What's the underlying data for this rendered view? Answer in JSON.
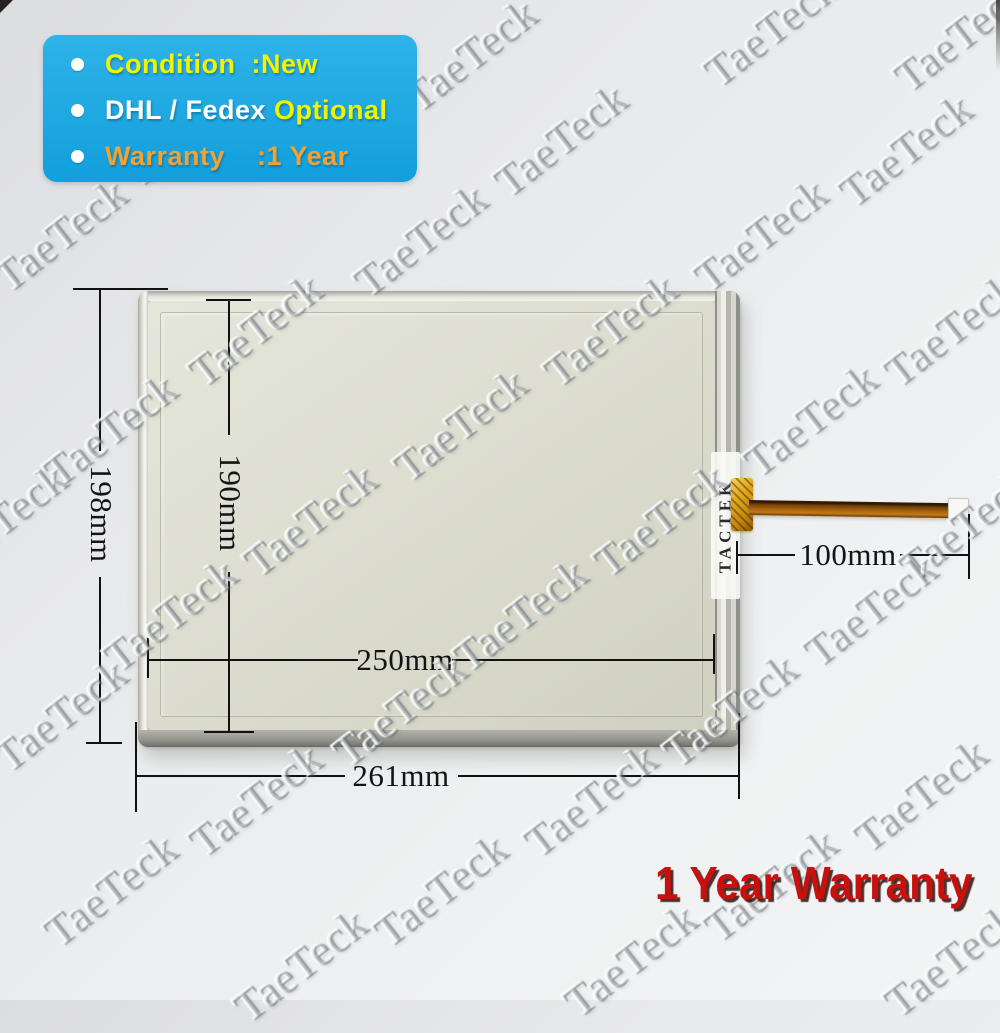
{
  "badge": {
    "bg_color_top": "#2fb3e8",
    "bg_color_bottom": "#129fdc",
    "items": [
      {
        "segments": [
          {
            "text": "Condition  :New",
            "color": "#f0f400"
          }
        ]
      },
      {
        "segments": [
          {
            "text": "DHL / Fedex ",
            "color": "#ffffff"
          },
          {
            "text": "Optional",
            "color": "#f0f400"
          }
        ]
      },
      {
        "segments": [
          {
            "text": "Warranty    :1 Year",
            "color": "#f0a235"
          }
        ]
      }
    ]
  },
  "panel": {
    "brand_label": "TACTEK"
  },
  "measurements": {
    "outer_height": "198mm",
    "inner_height": "190mm",
    "inner_width": "250mm",
    "outer_width": "261mm",
    "cable_length": "100mm"
  },
  "footer": {
    "warranty_text": "1 Year Warranty",
    "color": "#c8100d"
  },
  "watermark": {
    "text": "TaeTeck",
    "positions": [
      [
        470,
        55
      ],
      [
        770,
        30
      ],
      [
        960,
        35
      ],
      [
        190,
        130
      ],
      [
        560,
        140
      ],
      [
        905,
        150
      ],
      [
        60,
        235
      ],
      [
        420,
        240
      ],
      [
        760,
        235
      ],
      [
        255,
        330
      ],
      [
        610,
        330
      ],
      [
        950,
        330
      ],
      [
        110,
        430
      ],
      [
        460,
        425
      ],
      [
        810,
        420
      ],
      [
        0,
        520
      ],
      [
        310,
        520
      ],
      [
        660,
        520
      ],
      [
        965,
        525
      ],
      [
        170,
        615
      ],
      [
        520,
        615
      ],
      [
        870,
        610
      ],
      [
        60,
        715
      ],
      [
        400,
        710
      ],
      [
        730,
        710
      ],
      [
        255,
        800
      ],
      [
        590,
        800
      ],
      [
        920,
        795
      ],
      [
        110,
        890
      ],
      [
        440,
        890
      ],
      [
        770,
        885
      ],
      [
        300,
        965
      ],
      [
        630,
        960
      ],
      [
        950,
        960
      ]
    ]
  }
}
